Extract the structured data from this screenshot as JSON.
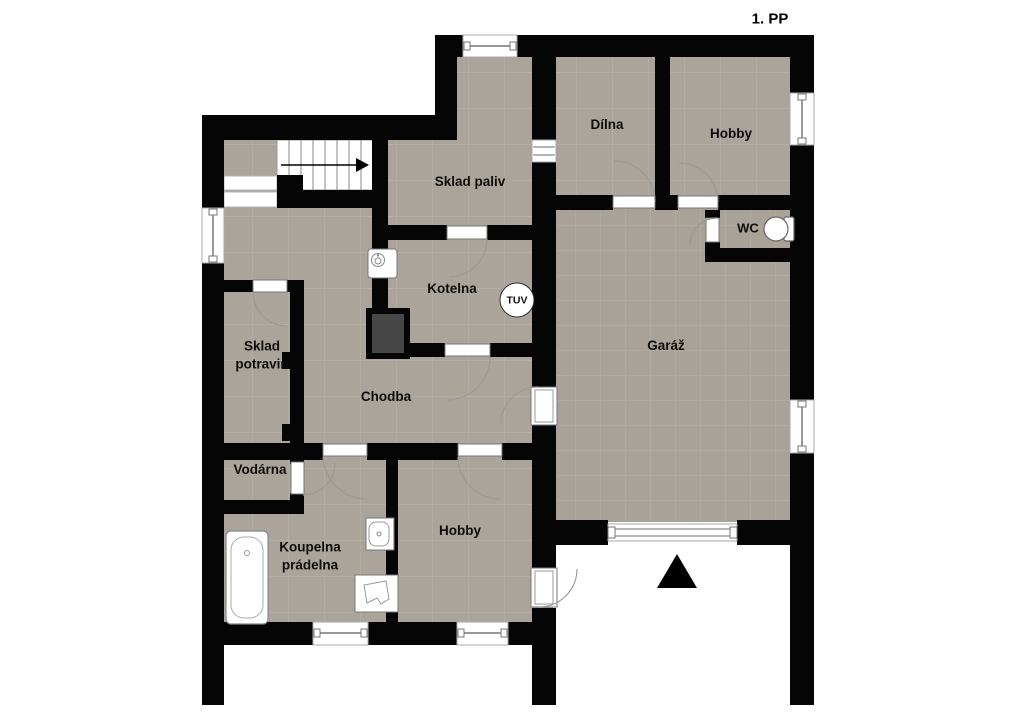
{
  "title": "1. PP",
  "rooms": [
    {
      "name": "dilna",
      "label": "Dílna"
    },
    {
      "name": "hobby-horni",
      "label": "Hobby"
    },
    {
      "name": "wc",
      "label": "WC"
    },
    {
      "name": "sklad-paliv",
      "label": "Sklad paliv"
    },
    {
      "name": "kotelna",
      "label": "Kotelna"
    },
    {
      "name": "garaz",
      "label": "Garáž"
    },
    {
      "name": "sklad-potravin",
      "label": "Sklad potravin"
    },
    {
      "name": "chodba",
      "label": "Chodba"
    },
    {
      "name": "vodarna",
      "label": "Vodárna"
    },
    {
      "name": "koupelna-pradelna",
      "label": "Koupelna prádelna"
    },
    {
      "name": "hobby-dolni",
      "label": "Hobby"
    }
  ],
  "badges": {
    "tuv": "TUV"
  },
  "colors": {
    "wall": "#050505",
    "floor": "#aaa49a",
    "floor_grid": "#b6b1a7",
    "background": "#ffffff",
    "symbol_line": "#888888"
  },
  "symbols": {
    "staircase": "treads with direction arrow",
    "entrance-arrow": "black triangle at garage drive",
    "garage-door": "double-line gate symbol",
    "bathtub": "rounded tub outline",
    "washbasin": "small basin outline",
    "utility-sink": "square with bowl outline",
    "boiler": "white cylinder with burner circle",
    "chimney": "dark filled square",
    "toilet": "bowl with cistern",
    "window": "white gap with mid glass line",
    "door": "white leaf with quarter-circle swing"
  }
}
